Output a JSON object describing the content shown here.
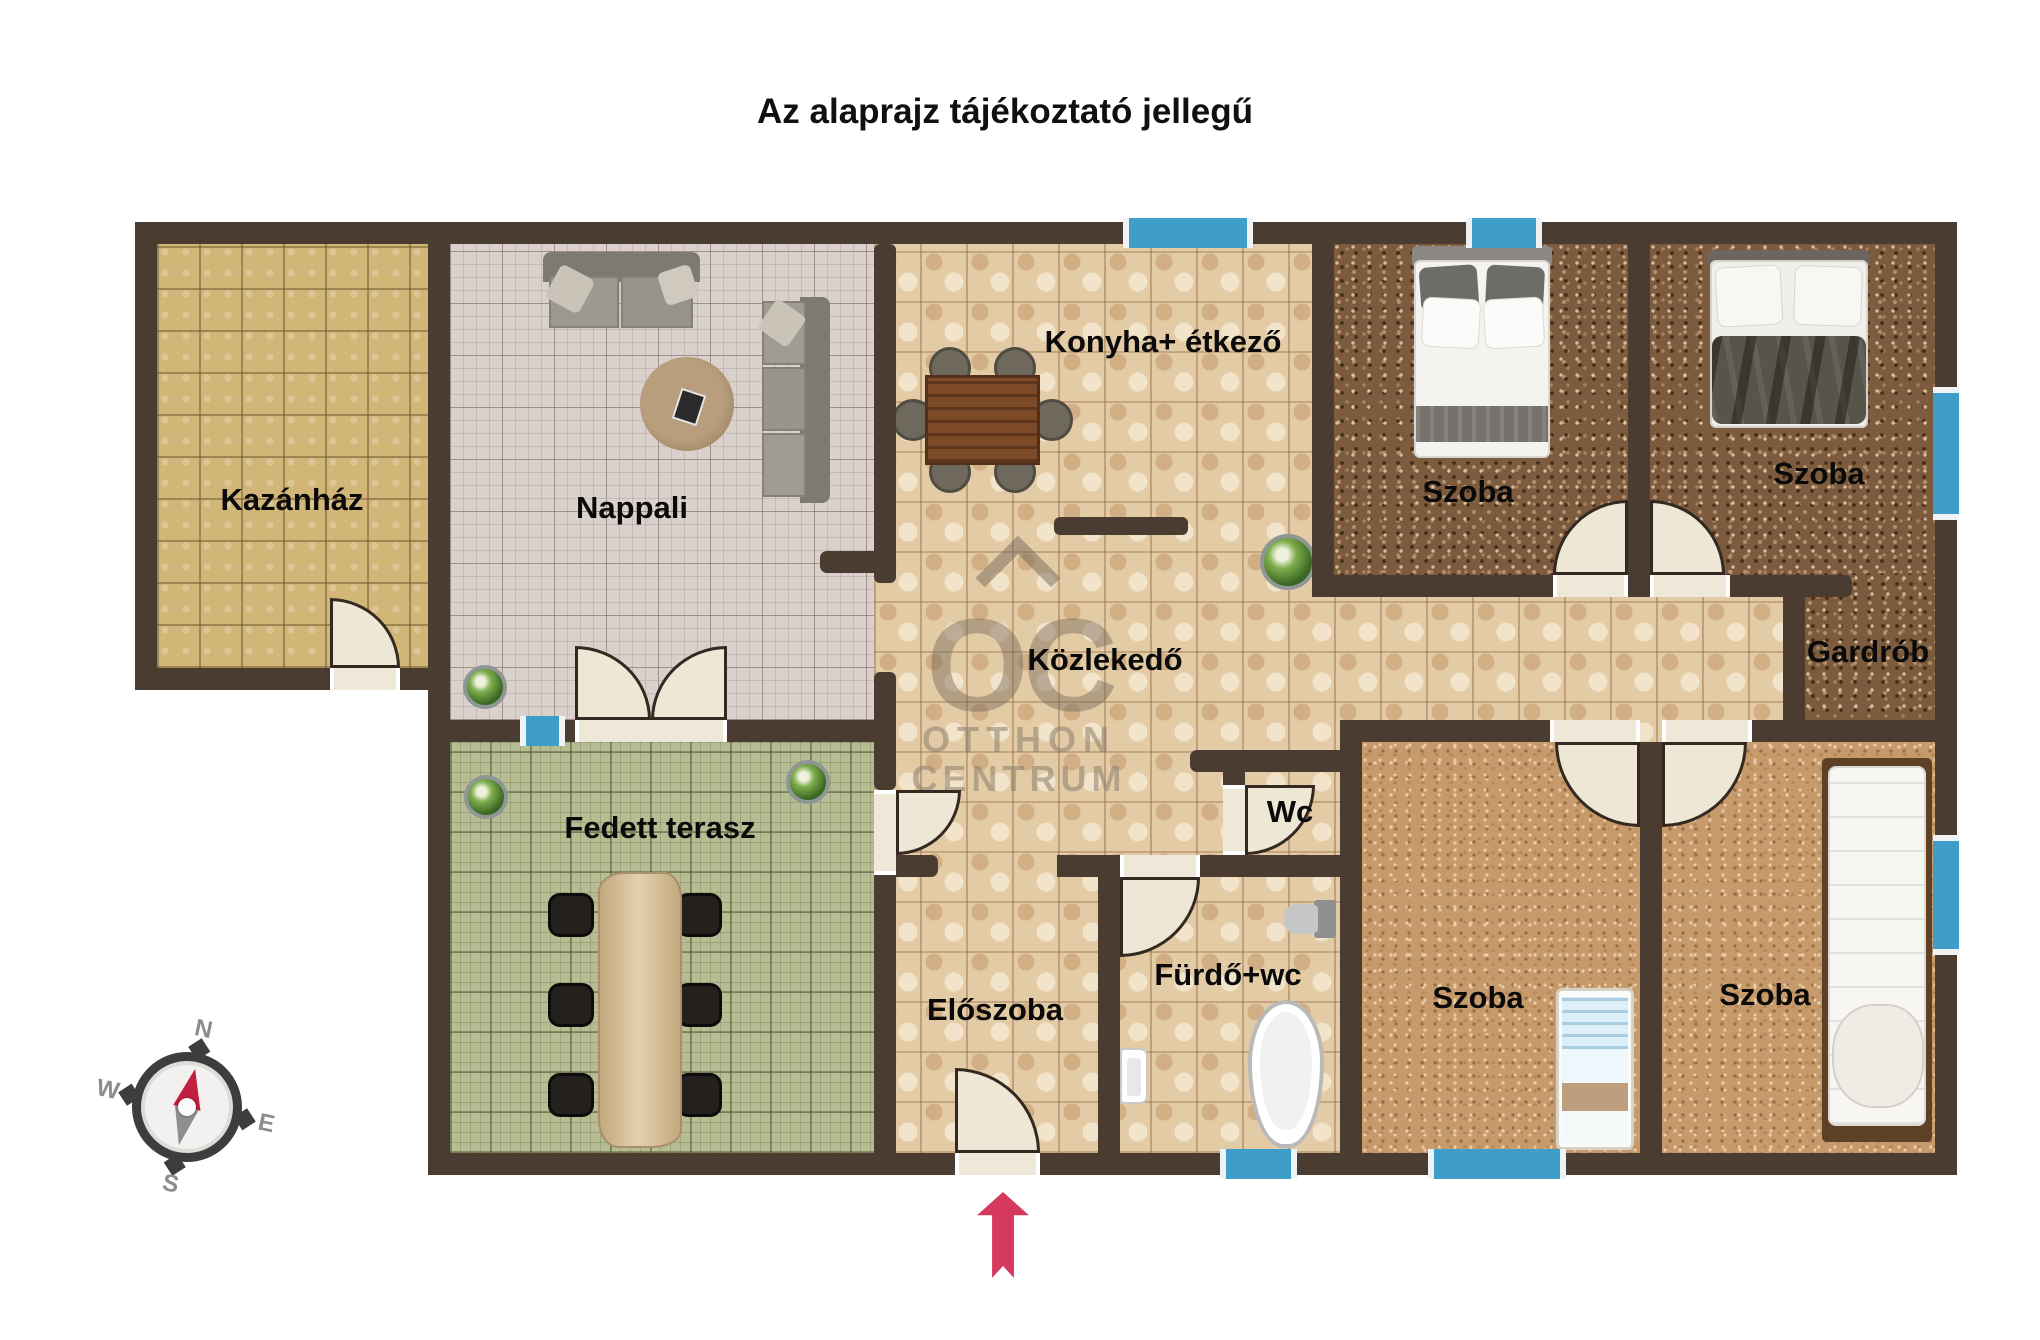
{
  "title": "Az alaprajz tájékoztató jellegű",
  "watermark": {
    "monogram": "OC",
    "line1": "OTTHON",
    "line2": "CENTRUM"
  },
  "compass": {
    "n": "N",
    "e": "E",
    "s": "S",
    "w": "W"
  },
  "rooms": [
    {
      "id": "kazanhaz",
      "label": "Kazánház"
    },
    {
      "id": "nappali",
      "label": "Nappali"
    },
    {
      "id": "konyha-etkezo",
      "label": "Konyha+ étkező"
    },
    {
      "id": "szoba-eszak-1",
      "label": "Szoba"
    },
    {
      "id": "szoba-eszak-2",
      "label": "Szoba"
    },
    {
      "id": "gardrob",
      "label": "Gardrób"
    },
    {
      "id": "kozlekedo",
      "label": "Közlekedő"
    },
    {
      "id": "wc",
      "label": "Wc"
    },
    {
      "id": "furdo-wc",
      "label": "Fürdő+wc"
    },
    {
      "id": "eloszoba",
      "label": "Előszoba"
    },
    {
      "id": "fedett-terasz",
      "label": "Fedett terasz"
    },
    {
      "id": "szoba-del-1",
      "label": "Szoba"
    },
    {
      "id": "szoba-del-2",
      "label": "Szoba"
    }
  ],
  "colors": {
    "wall": "#4a3c31",
    "window_blue": "#3f9dc9",
    "door_leaf": "#efe7d5",
    "entrance_arrow_red": "#d53a5e",
    "label_black": "#0a0a0a"
  }
}
